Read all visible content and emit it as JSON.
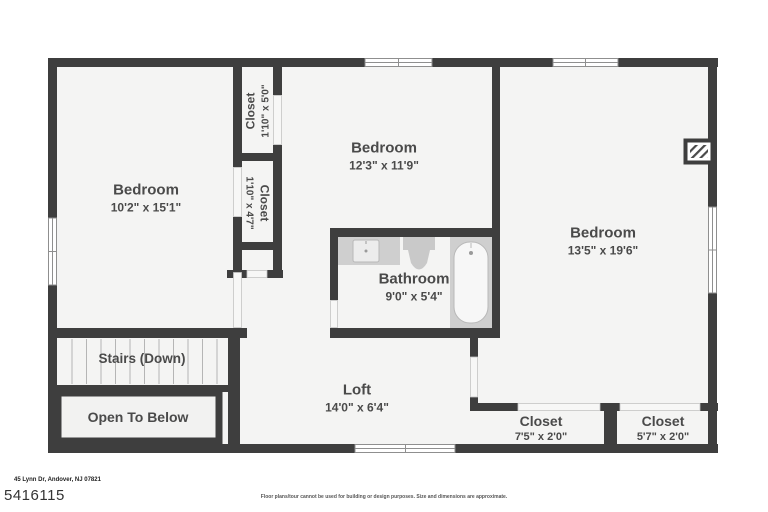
{
  "rooms": {
    "bedroom_left": {
      "label": "Bedroom",
      "dimensions": "10'2\" x 15'1\""
    },
    "closet_top": {
      "label": "Closet",
      "dimensions": "1'10\" x 5'0\""
    },
    "closet_mid": {
      "label": "Closet",
      "dimensions": "1'10\" x 4'7\""
    },
    "bedroom_middle": {
      "label": "Bedroom",
      "dimensions": "12'3\" x 11'9\""
    },
    "bedroom_right": {
      "label": "Bedroom",
      "dimensions": "13'5\" x 19'6\""
    },
    "bathroom": {
      "label": "Bathroom",
      "dimensions": "9'0\" x 5'4\""
    },
    "stairs": {
      "label": "Stairs (Down)"
    },
    "open_to_below": {
      "label": "Open To Below"
    },
    "loft": {
      "label": "Loft",
      "dimensions": "14'0\" x 6'4\""
    },
    "closet_bottom_left": {
      "label": "Closet",
      "dimensions": "7'5\" x 2'0\""
    },
    "closet_bottom_right": {
      "label": "Closet",
      "dimensions": "5'7\" x 2'0\""
    }
  },
  "footer": {
    "address": "45 Lynn Dr, Andover, NJ 07821",
    "listing_id": "5416115",
    "disclaimer": "Floor plans/tour cannot be used for building or design purposes. Size and dimensions are approximate."
  },
  "colors": {
    "wall": "#3e3e3e",
    "room_fill": "#f4f4f3",
    "label_text": "#4a4a4a",
    "fixture_gray": "#cccccc"
  }
}
